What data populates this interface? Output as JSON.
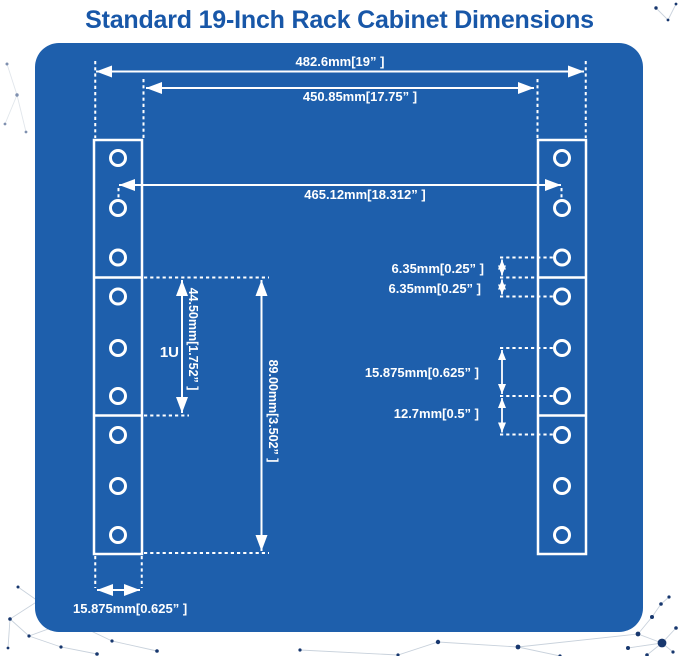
{
  "title": "Standard 19-Inch Rack Cabinet Dimensions",
  "colors": {
    "background": "#FFFFFF",
    "panel": "#1E5FAC",
    "title_text": "#1857A8",
    "line": "#FFFFFF",
    "dot": "#17376E",
    "web_line": "#C9D2DC"
  },
  "diagram": {
    "labels": {
      "outer_width": "482.6mm[19” ]",
      "inner_width": "450.85mm[17.75” ]",
      "hole_center_width": "465.12mm[18.312” ]",
      "hole_to_unit_edge_top": "6.35mm[0.25” ]",
      "hole_to_unit_edge_bottom": "6.35mm[0.25” ]",
      "hole_pitch": "15.875mm[0.625” ]",
      "hole_pitch_across_units": "12.7mm[0.5” ]",
      "unit_height": "44.50mm[1.752” ]",
      "unit": "1U",
      "three_hole_span": "89.00mm[3.502” ]",
      "flange_width": "15.875mm[0.625” ]"
    }
  }
}
